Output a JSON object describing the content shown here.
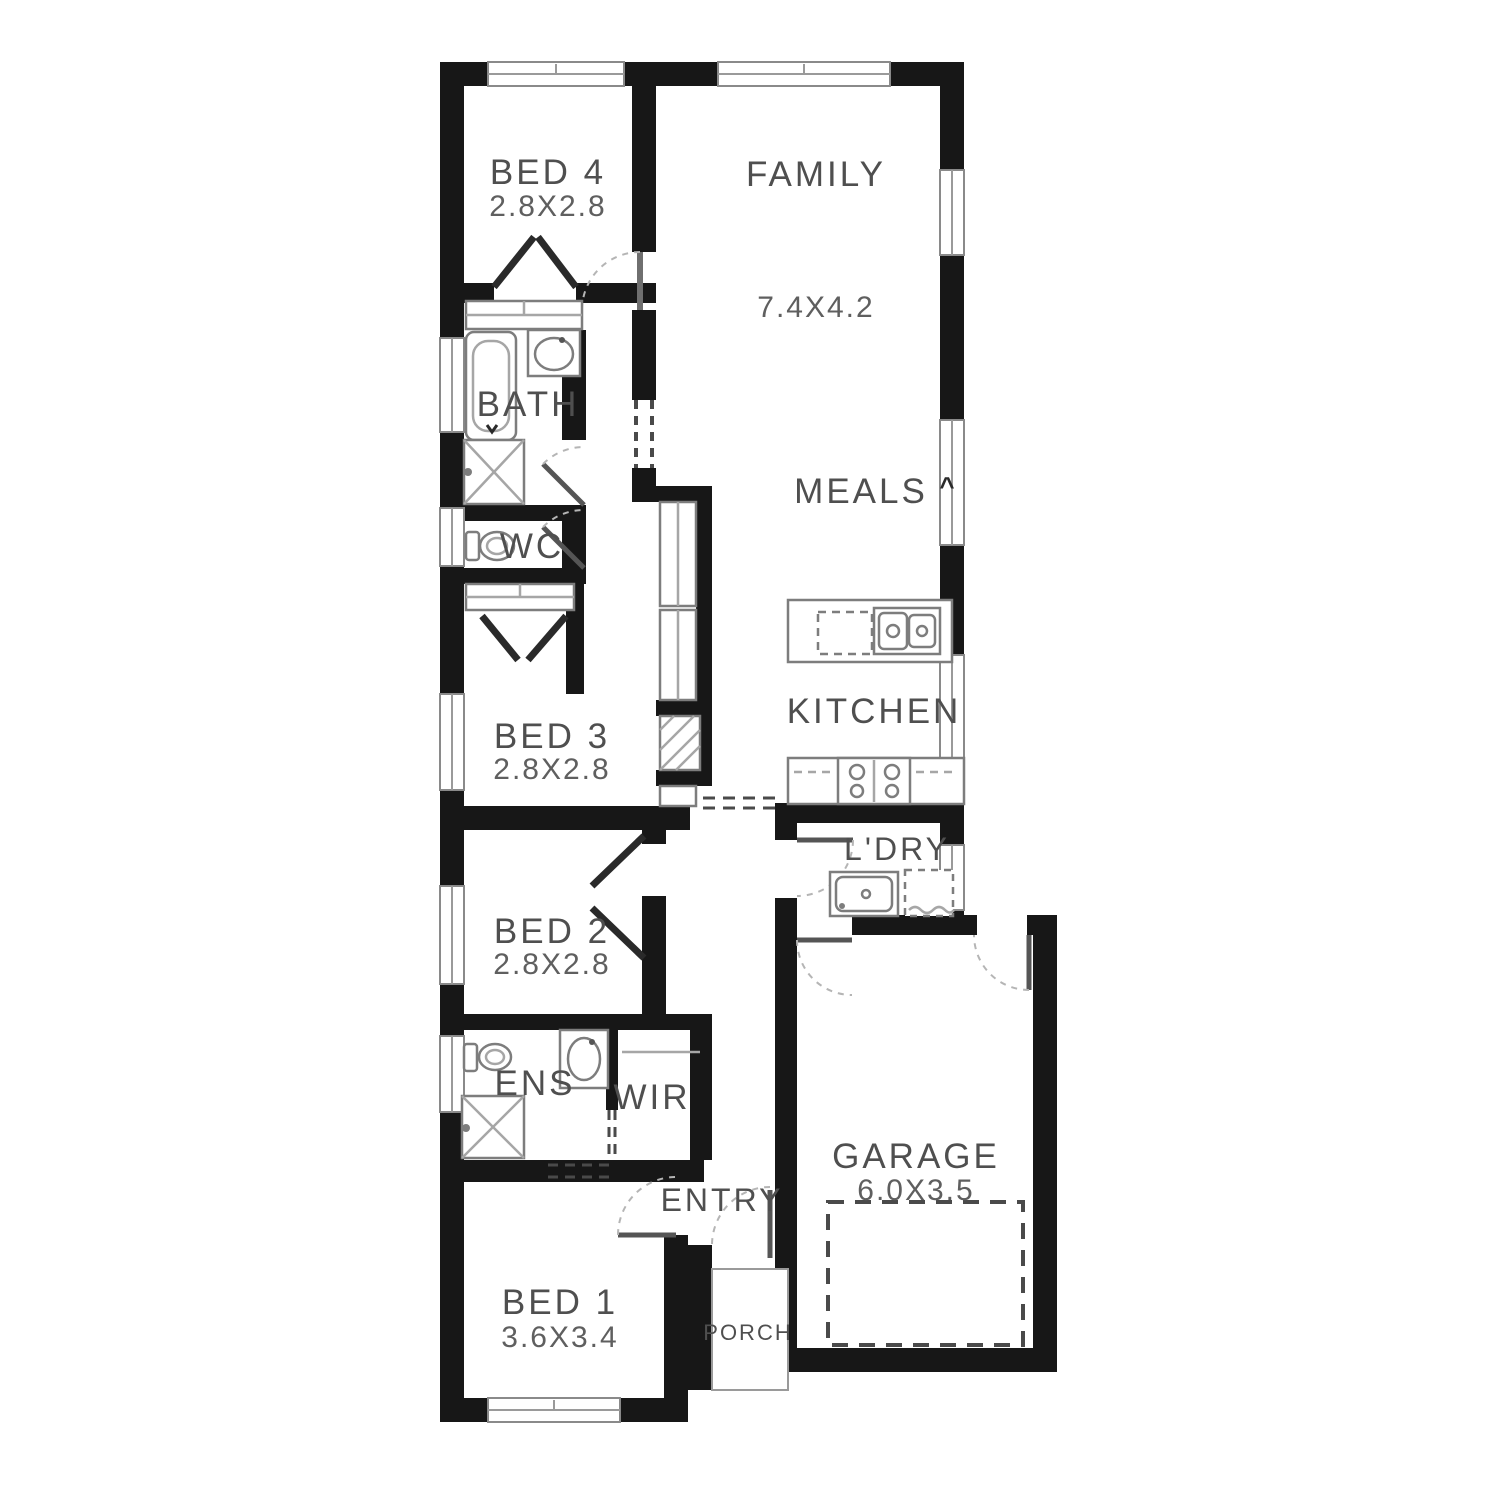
{
  "meta": {
    "type": "architectural-floor-plan"
  },
  "colors": {
    "wall": "#171717",
    "fixture": "#7d7d7d",
    "fixture_light": "#a6a6a6",
    "text": "#4f4f4f",
    "dim_text": "#5f5f5f",
    "door_arc": "#b5b5b5",
    "dark_dash": "#4a4a4a"
  },
  "rooms": {
    "bed4": {
      "label": "BED 4",
      "dims": "2.8X2.8"
    },
    "family": {
      "label": "FAMILY",
      "dims": "7.4X4.2"
    },
    "bath": {
      "label": "BATH"
    },
    "meals": {
      "label": "MEALS"
    },
    "wc": {
      "label": "WC"
    },
    "bed3": {
      "label": "BED 3",
      "dims": "2.8X2.8"
    },
    "kitchen": {
      "label": "KITCHEN"
    },
    "laundry": {
      "label": "L'DRY"
    },
    "bed2": {
      "label": "BED 2",
      "dims": "2.8X2.8"
    },
    "ens": {
      "label": "ENS"
    },
    "wir": {
      "label": "WIR"
    },
    "garage": {
      "label": "GARAGE",
      "dims": "6.0X3.5"
    },
    "entry": {
      "label": "ENTRY"
    },
    "bed1": {
      "label": "BED 1",
      "dims": "3.6X3.4"
    },
    "porch": {
      "label": "PORCH"
    }
  },
  "markers": {
    "meals_door": "^"
  }
}
